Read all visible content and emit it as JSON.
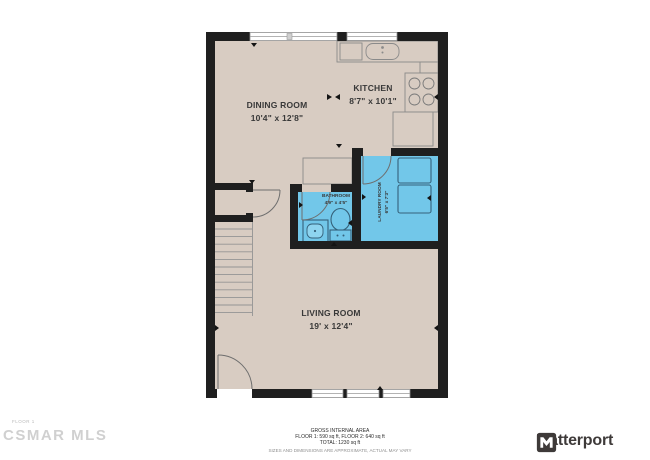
{
  "colors": {
    "floor": "#d8ccc2",
    "wall": "#1f1f1f",
    "highlight": "#72c7e9",
    "fixture": "#35617a",
    "brand": "#3e3a39"
  },
  "rooms": {
    "dining": {
      "name": "DINING ROOM",
      "dims": "10'4\" x 12'8\""
    },
    "kitchen": {
      "name": "KITCHEN",
      "dims": "8'7\" x 10'1\""
    },
    "bathroom": {
      "name": "BATHROOM",
      "dims": "4'9\" x 4'5\""
    },
    "laundry": {
      "name": "LAUNDRY ROOM",
      "dims": "6'5\" x 7'3\""
    },
    "living": {
      "name": "LIVING ROOM",
      "dims": "19' x 12'4\""
    }
  },
  "footer": {
    "title": "GROSS INTERNAL AREA",
    "floors": "FLOOR 1: 590 sq ft, FLOOR 2: 640 sq ft",
    "total": "TOTAL: 1230 sq ft",
    "disclaimer": "SIZES AND DIMENSIONS ARE APPROXIMATE, ACTUAL MAY VARY"
  },
  "watermark": {
    "floor_label": "FLOOR 1",
    "text": "CSMAR MLS"
  },
  "brand": {
    "name": "Matterport"
  }
}
